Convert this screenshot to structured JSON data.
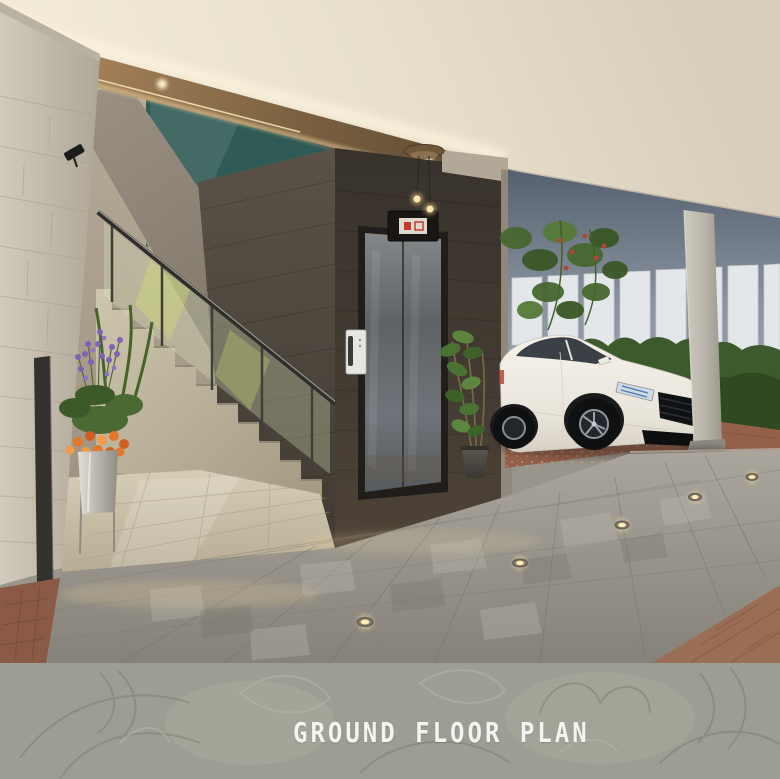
{
  "banner": {
    "title": "GROUND FLOOR PLAN"
  },
  "palette": {
    "banner-bg": "#9a9e93",
    "banner-text": "#f4f4f1",
    "banner-leaf-dark": "#7e8272",
    "banner-leaf-light": "#b1b5a6",
    "ceiling": "#e9e0cf",
    "cove-light": "#ffe9bd",
    "stone-wall": "#c6bfaf",
    "slate-wall": "#46403a",
    "elevator-door": "#6a6e72",
    "indicator-red": "#c43b2e",
    "glass-teal": "#2f5a55",
    "back-wall": "#8a95a2",
    "fence": "#e4e7e9",
    "hedge": "#3c5a2b",
    "car-body": "#f2efe7",
    "terracotta": "#94604a",
    "pavement": "#96928a",
    "lobby-floor": "#c6bda8",
    "flower-purple": "#7e63b4",
    "flower-orange": "#e2782a"
  }
}
